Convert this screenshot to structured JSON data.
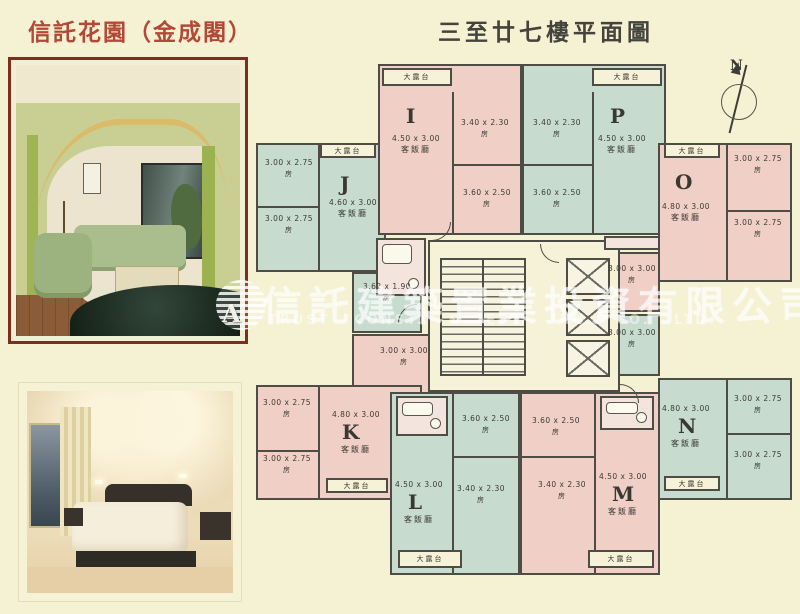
{
  "page": {
    "background": "#f5f1d3"
  },
  "header": {
    "title_left": "信託花園（金成閣）",
    "title_right": "三至廿七樓平面圖",
    "title_left_color": "#b24936",
    "title_right_color": "#44443c"
  },
  "watermark": {
    "logo_letter": "A",
    "company_cn": "信託建築置業投資有限公司",
    "company_en": "TRUST CONST. & EST. INV. CO. LTD."
  },
  "compass": {
    "north_label": "N"
  },
  "plan": {
    "balcony_label": "大露台",
    "room_label": "房",
    "living_room_label": "客飯廳",
    "wall_color": "#4e4d45",
    "pink_unit_color": "#f0cfc6",
    "green_unit_color": "#c7dccf",
    "units": {
      "I": {
        "letter": "I",
        "living_dim": "4.50 x 3.00",
        "room1_dim": "3.40 x 2.30",
        "room2_dim": "3.60 x 2.50"
      },
      "J": {
        "letter": "J",
        "living_dim": "4.60 x 3.00",
        "room1_dim": "3.00 x 2.75",
        "room2_dim": "3.00 x 2.75",
        "room3_dim": "3.62 x 1.90"
      },
      "K": {
        "letter": "K",
        "living_dim": "4.80 x 3.00",
        "room1_dim": "3.00 x 2.75",
        "room2_dim": "3.00 x 2.75",
        "room3_dim": "3.00 x 3.00"
      },
      "L": {
        "letter": "L",
        "living_dim": "4.50 x 3.00",
        "room1_dim": "3.60 x 2.50",
        "room2_dim": "3.40 x 2.30"
      },
      "M": {
        "letter": "M",
        "living_dim": "4.50 x 3.00",
        "room1_dim": "3.60 x 2.50",
        "room2_dim": "3.40 x 2.30"
      },
      "N": {
        "letter": "N",
        "living_dim": "4.80 x 3.00",
        "room1_dim": "3.00 x 2.75",
        "room2_dim": "3.00 x 2.75",
        "room3_dim": "3.00 x 3.00"
      },
      "O": {
        "letter": "O",
        "living_dim": "4.80 x 3.00",
        "room1_dim": "3.00 x 2.75",
        "room2_dim": "3.00 x 2.75",
        "room3_dim": "3.00 x 3.00"
      },
      "P": {
        "letter": "P",
        "living_dim": "4.50 x 3.00",
        "room1_dim": "3.40 x 2.30",
        "room2_dim": "3.60 x 2.50"
      }
    }
  }
}
